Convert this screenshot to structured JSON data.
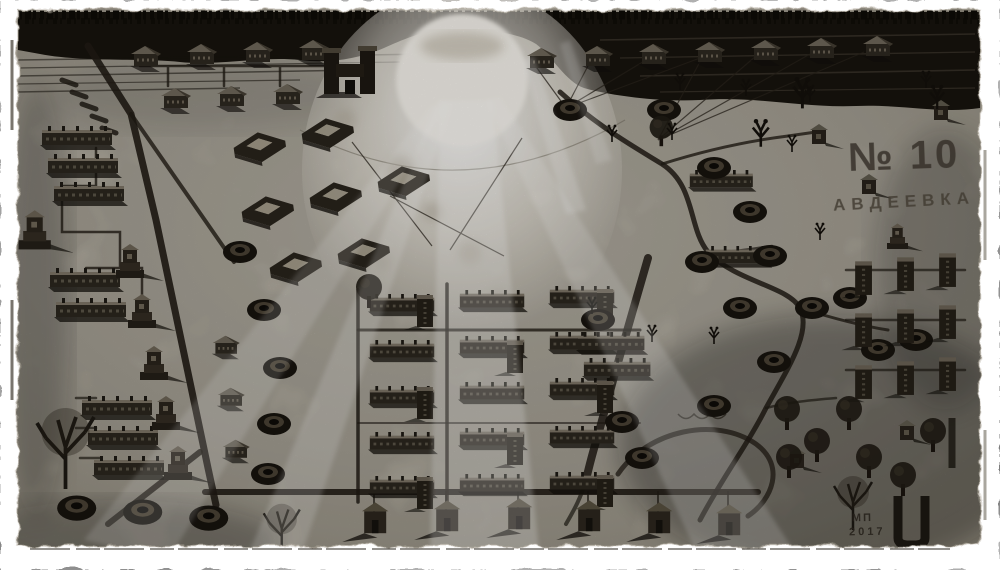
{
  "artwork": {
    "district_label": "№ 10",
    "town_label": "АВДЕЕВКА",
    "signature_initials": "МП",
    "signature_year": "2017",
    "palette": {
      "paper": "#fdfdfb",
      "plate_tone": "#c6c0b2",
      "ink_dark": "#17130d",
      "ink_mid": "#55503f",
      "sun_white": "#f6f3ec"
    }
  }
}
